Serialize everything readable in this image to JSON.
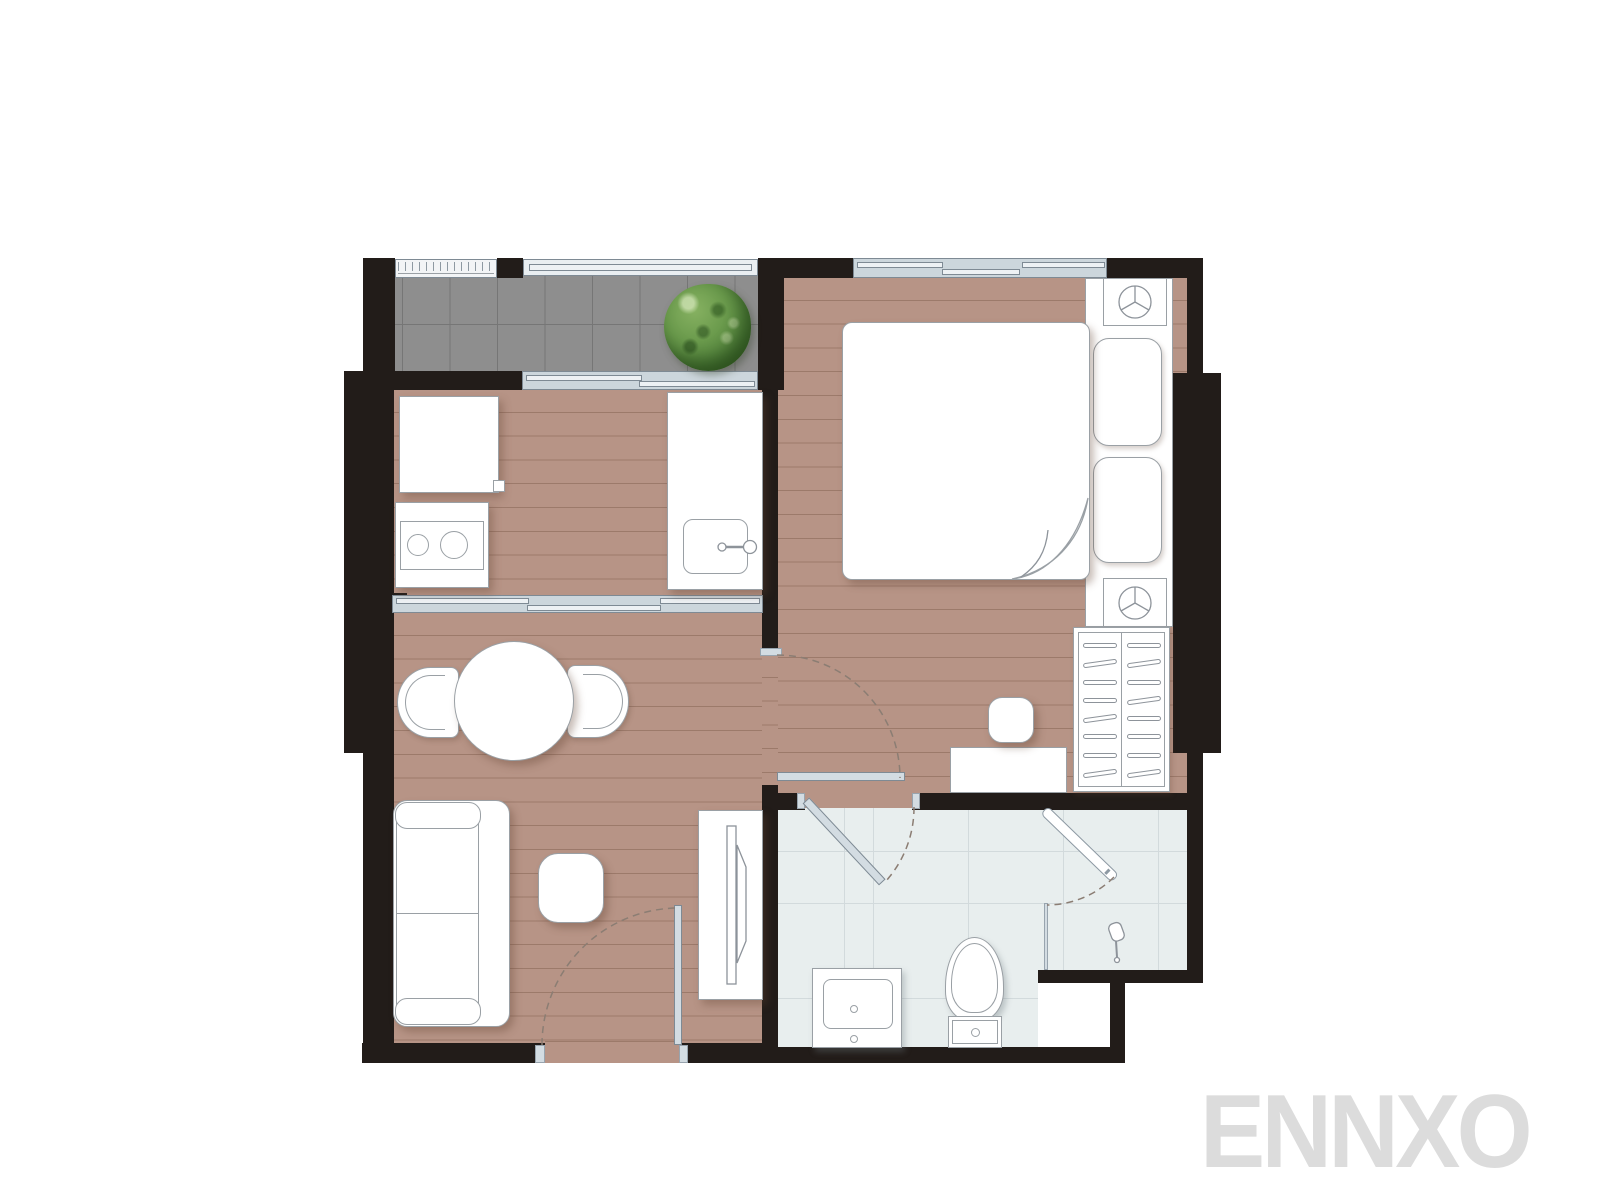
{
  "watermark": {
    "text": "ENNXO"
  },
  "palette": {
    "wall": "#221c19",
    "wood_floor": "#b79486",
    "balcony_tile": "#8e8e8e",
    "bath_tile": "#e8eeee",
    "glass_frame": "#7e8a94",
    "glass_fill": "#ccd6dc",
    "glass_pane": "#edf1f4",
    "door_leaf": "#d3dce2",
    "furniture_outline": "#9aa0a5",
    "tree_green": "#5d8a45",
    "watermark": "#dcdcdc",
    "background": "#ffffff"
  },
  "icons": {
    "plant_icon": "round shrub top view on balcony",
    "lamp_icon": "circle with three spokes on each nightstand",
    "bed_icon": "double bed with folded duvet corner",
    "wardrobe_icon": "closet with clothes hangers",
    "sofa_icon": "two-seat sofa",
    "pouf_icon": "rounded square stool",
    "dining_icon": "round table with two curved chairs",
    "tv_icon": "flat TV on media console",
    "stove_icon": "two burner hob",
    "sink_icon": "kitchen sink with faucet",
    "vanity_icon": "bathroom washbasin",
    "toilet_icon": "toilet with cistern",
    "shower_icon": "shower head and glass swing door",
    "door_swing_icon": "dashed quarter-circle door swing arcs"
  }
}
